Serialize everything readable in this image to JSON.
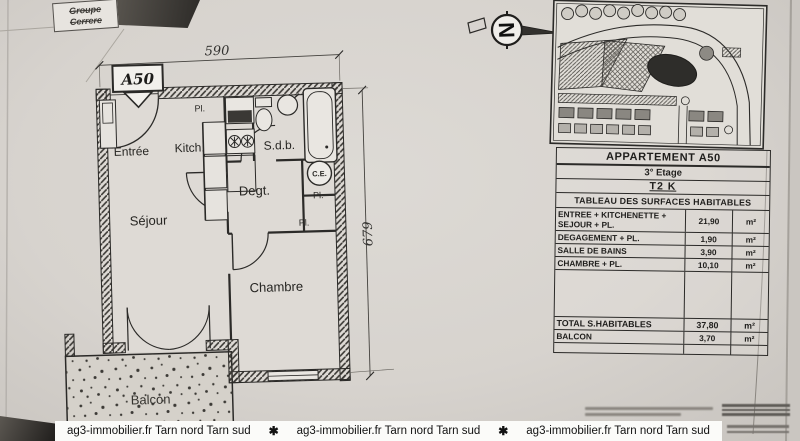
{
  "logo": {
    "line1": "Groupe",
    "line2": "Cerrere"
  },
  "plan": {
    "tag": "A50",
    "dim_width": "590",
    "dim_height": "679",
    "compass_letter": "N",
    "labels": {
      "entree": "Entrée",
      "kitchen": "Kitch.",
      "sdb": "S.d.b.",
      "degt": "Degt.",
      "sejour": "Séjour",
      "chambre": "Chambre",
      "balcon": "Balcon",
      "pl1": "Pl.",
      "pl2": "Pl.",
      "pl3": "Pl.",
      "ce": "C.E."
    }
  },
  "panel": {
    "title": "APPARTEMENT A50",
    "floor": "3° Etage",
    "type": "T2 K",
    "table_title": "TABLEAU DES SURFACES HABITABLES",
    "rows": [
      {
        "label": "ENTREE + KITCHENETTE + SEJOUR + PL.",
        "value": "21,90",
        "unit": "m²"
      },
      {
        "label": "DEGAGEMENT + PL.",
        "value": "1,90",
        "unit": "m²"
      },
      {
        "label": "SALLE DE BAINS",
        "value": "3,90",
        "unit": "m²"
      },
      {
        "label": "CHAMBRE + PL.",
        "value": "10,10",
        "unit": "m²"
      }
    ],
    "total_row": {
      "label": "TOTAL S.HABITABLES",
      "value": "37,80",
      "unit": "m²"
    },
    "balcon_row": {
      "label": "BALCON",
      "value": "3,70",
      "unit": "m²"
    }
  },
  "watermark": {
    "text": "ag3-immobilier.fr  Tarn nord Tarn sud",
    "separator": "✱"
  },
  "colors": {
    "paper": "#d7d3ce",
    "ink": "#2b2a28",
    "band": "#fbfbf9"
  }
}
